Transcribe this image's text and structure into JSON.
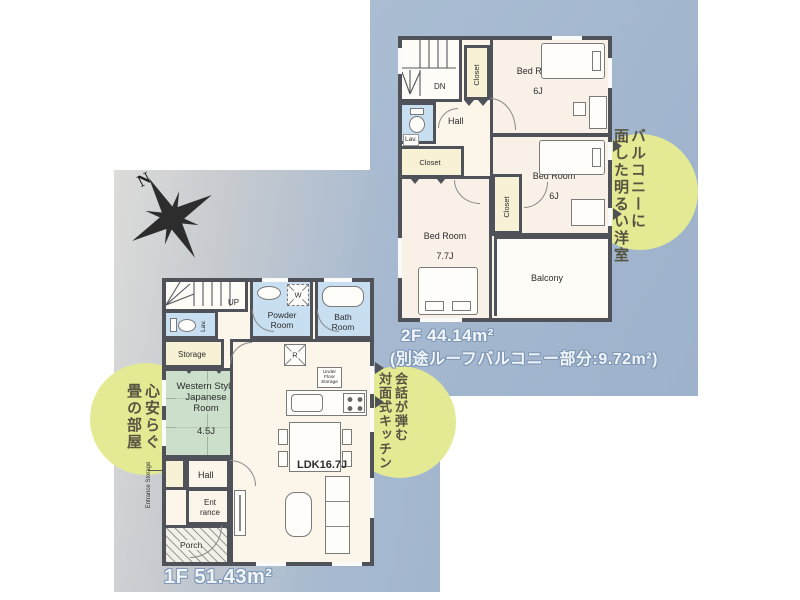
{
  "colors": {
    "backdrop_blue": "#a2b6ce",
    "panel_gray": "#d9d9d7",
    "wall": "#50525a",
    "wet_blue": "#c7dff1",
    "closet_cream": "#f7f2d5",
    "tatami_green": "#ccdfca",
    "highlight_yellow": "#e4e994"
  },
  "compass": {
    "label": "N"
  },
  "floor2": {
    "title": "2F 44.14m²",
    "subtitle": "(別途ルーフバルコニー部分:9.72m²)",
    "catchphrase": {
      "line1": "バルコニーに",
      "line2": "面した明るい洋室"
    },
    "rooms": {
      "stairs": "DN",
      "lav": "Lav.",
      "hall": "Hall",
      "closet_top": "Closet",
      "closet_left": "Closet",
      "closet_mid": "Closet",
      "bedroom1_name": "Bed Room",
      "bedroom1_size": "6J",
      "bedroom2_name": "Bed Room",
      "bedroom2_size": "6J",
      "bedroom3_name": "Bed Room",
      "bedroom3_size": "7.7J",
      "balcony": "Balcony"
    }
  },
  "floor1": {
    "title": "1F 51.43m²",
    "catchphrase_left": {
      "line1": "心安らぐ",
      "line2": "畳の部屋"
    },
    "catchphrase_right": {
      "line1": "会話が弾む",
      "line2": "対面式キッチン"
    },
    "rooms": {
      "stairs": "UP",
      "lav": "Lav.",
      "powder": "Powder Room",
      "bath": "Bath Room",
      "storage": "Storage",
      "washer": "W",
      "fridge": "R",
      "japanese_room": "Western Style Japanese Room",
      "japanese_room_size": "4.5J",
      "hall": "Hall",
      "entrance": "Ent rance",
      "entrance_storage": "Entrance Storage",
      "porch": "Porch",
      "ldk": "LDK16.7J",
      "underfloor_storage": "Under Floor Storage"
    }
  }
}
